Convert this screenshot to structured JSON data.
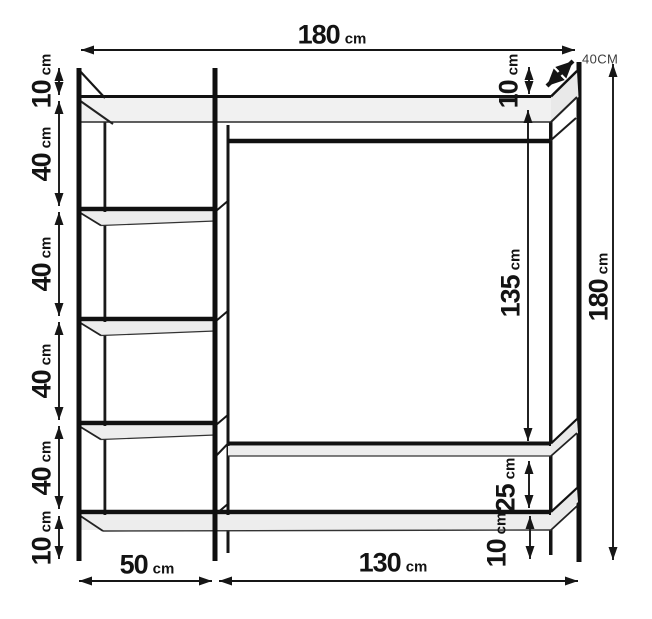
{
  "colors": {
    "line": "#141414",
    "shelf_fill": "#ededed",
    "shelf_fill_light": "#f1f1f1",
    "background": "#ffffff",
    "depth_label_color": "#3d3d3d"
  },
  "diagram": {
    "type": "furniture-dimension-diagram",
    "subject": "open wardrobe shelving unit with hanging rail, front view with depth cue",
    "dimensions": {
      "top_width": {
        "value": "180",
        "unit": "cm"
      },
      "depth": {
        "value": "40CM"
      },
      "right_height": {
        "value": "180",
        "unit": "cm"
      },
      "left_column": [
        {
          "value": "10",
          "unit": "cm"
        },
        {
          "value": "40",
          "unit": "cm"
        },
        {
          "value": "40",
          "unit": "cm"
        },
        {
          "value": "40",
          "unit": "cm"
        },
        {
          "value": "40",
          "unit": "cm"
        },
        {
          "value": "10",
          "unit": "cm"
        }
      ],
      "inner_right_column": [
        {
          "value": "10",
          "unit": "cm"
        },
        {
          "value": "135",
          "unit": "cm"
        },
        {
          "value": "25",
          "unit": "cm"
        },
        {
          "value": "10",
          "unit": "cm"
        }
      ],
      "bottom_row": [
        {
          "value": "50",
          "unit": "cm"
        },
        {
          "value": "130",
          "unit": "cm"
        }
      ]
    }
  }
}
